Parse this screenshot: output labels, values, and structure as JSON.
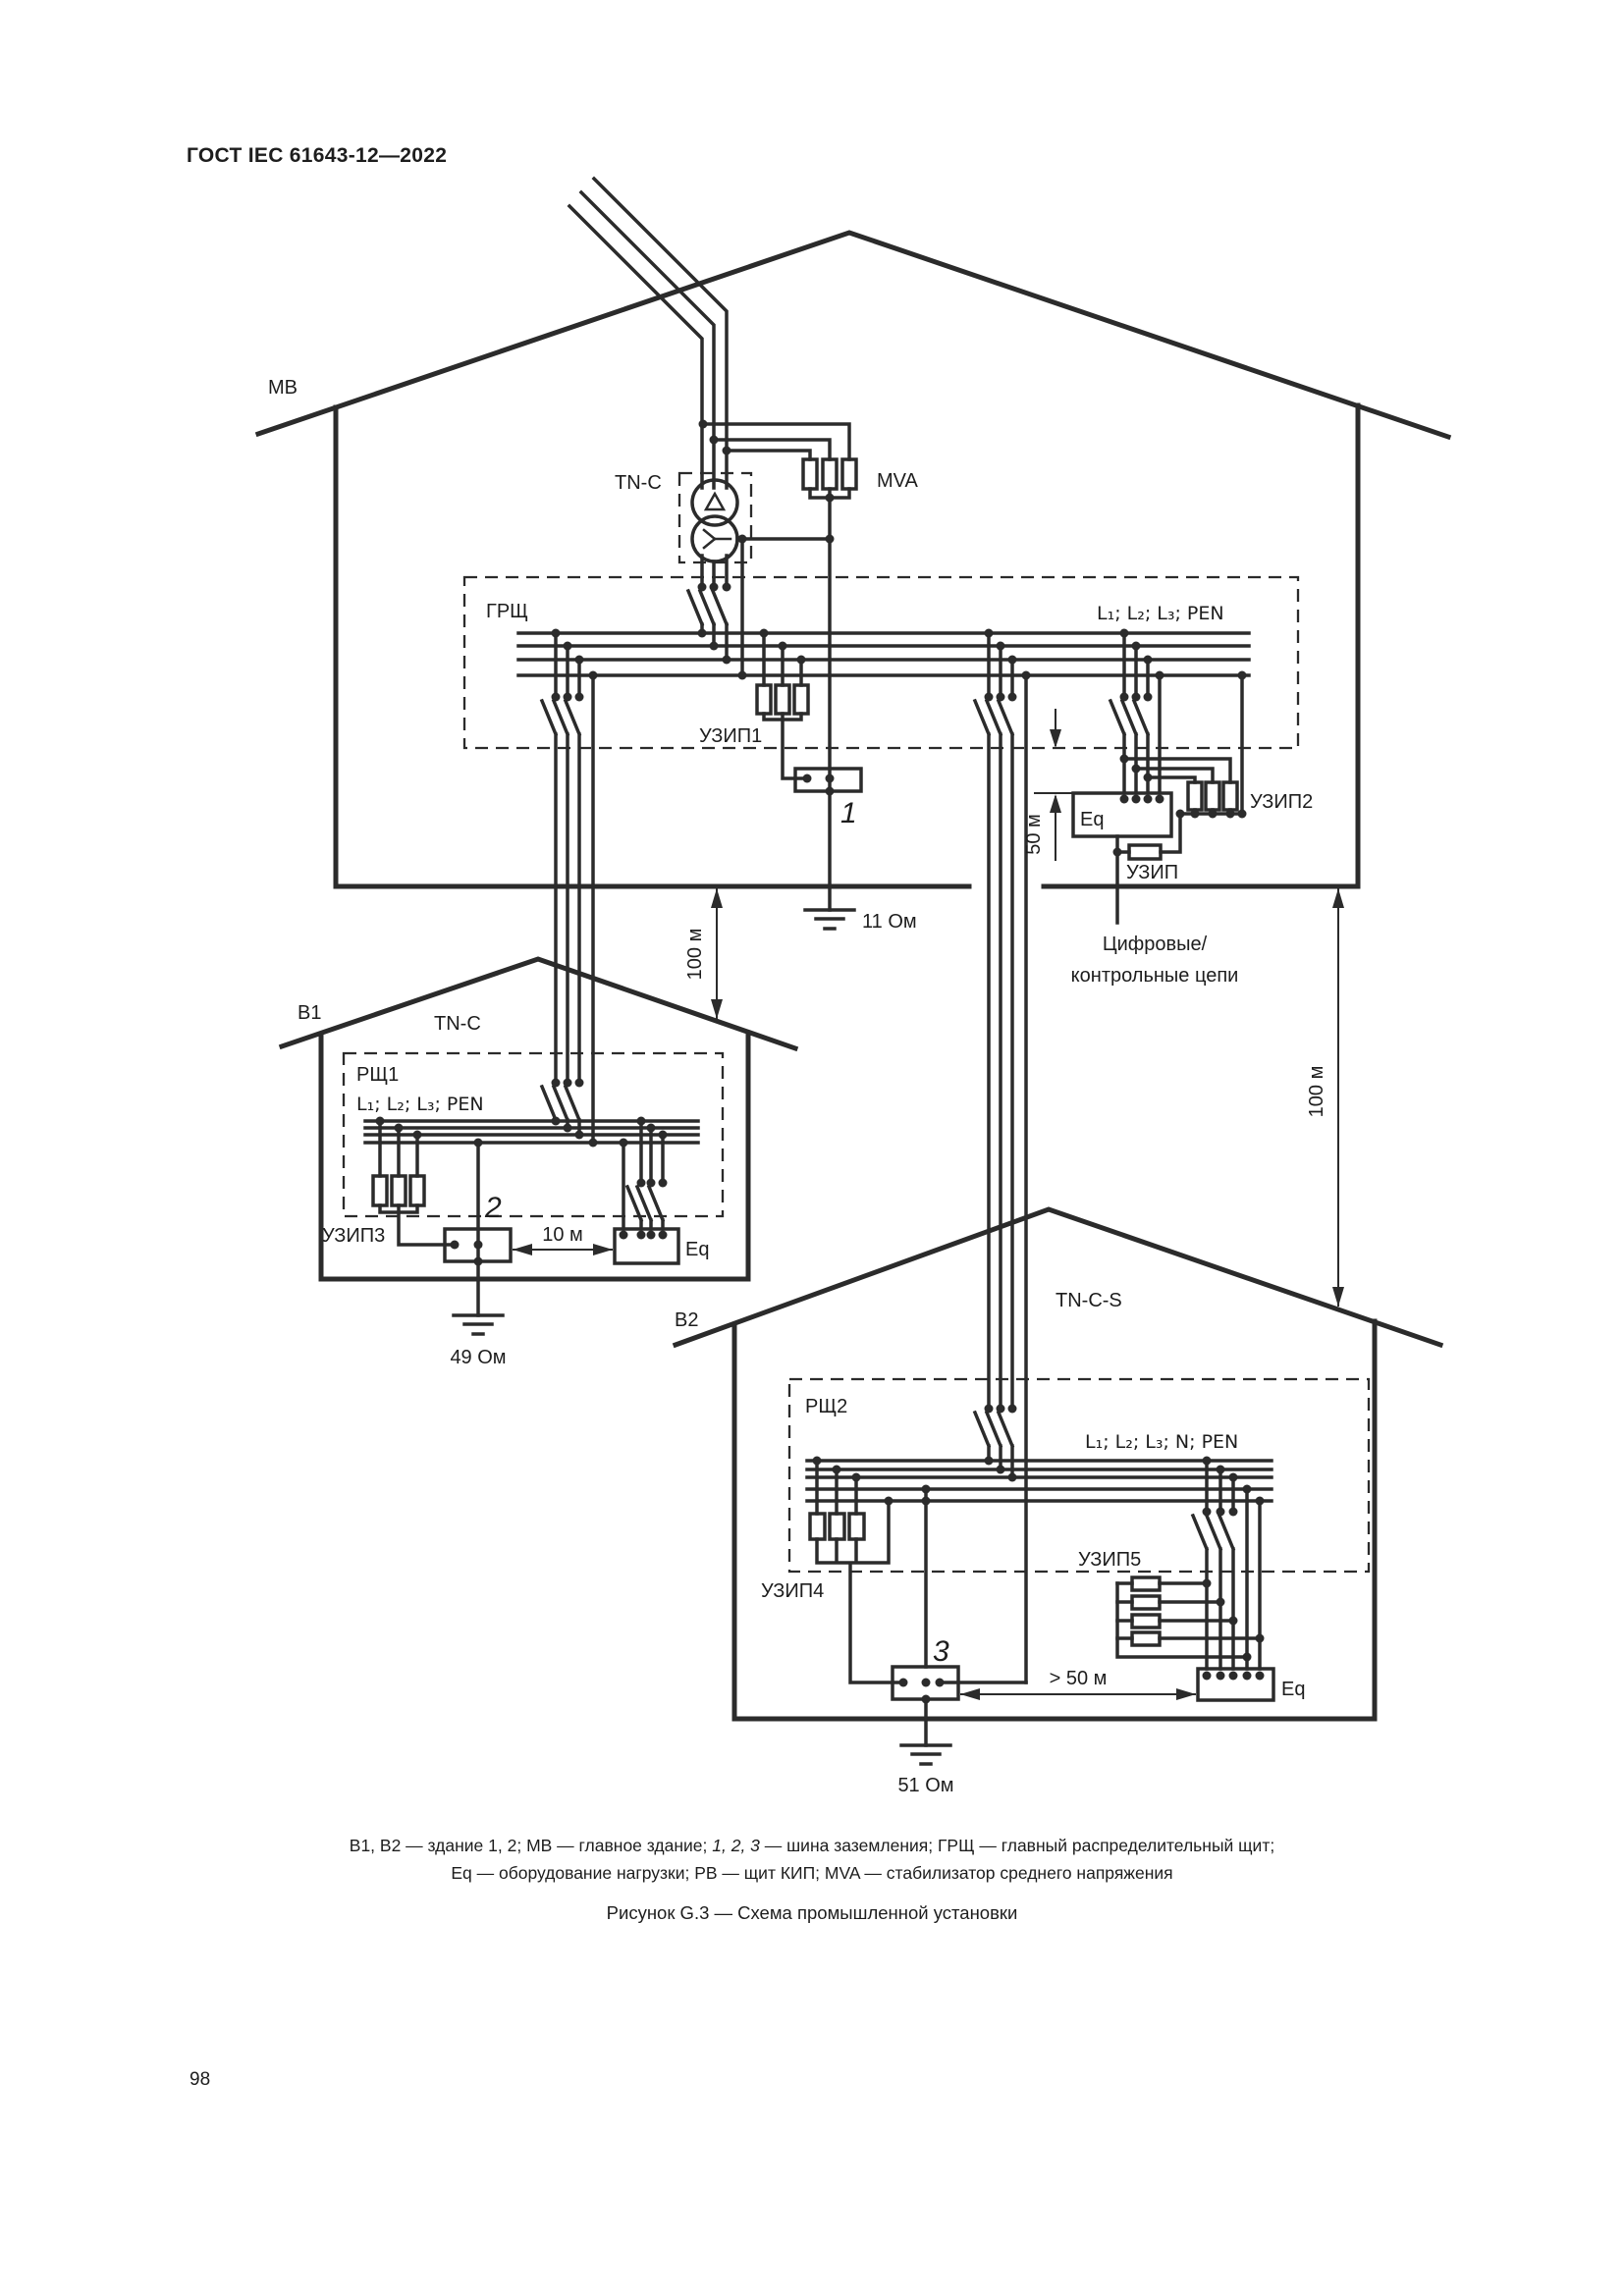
{
  "page": {
    "header_title": "ГОСТ IEC 61643-12—2022",
    "page_number": "98"
  },
  "diagram": {
    "dims": {
      "m100_left": "100 м",
      "m100_right": "100 м",
      "m50": "50 м",
      "m10": "10 м",
      "m50_plus": "> 50 м"
    },
    "main_building": {
      "label": "МВ",
      "system": "TN-C",
      "mva": "MVA",
      "board": "ГРЩ",
      "phases": "L₁; L₂; L₃; PEN",
      "spd1": "УЗИП1",
      "spd2": "УЗИП2",
      "spd": "УЗИП",
      "equipment": "Eq",
      "earth_bus": "1",
      "earth_resistance": "11 Ом",
      "digital_line1": "Цифровые/",
      "digital_line2": "контрольные цепи"
    },
    "building1": {
      "label": "B1",
      "system": "TN-C",
      "board": "РЩ1",
      "phases": "L₁; L₂; L₃; PEN",
      "spd3": "УЗИП3",
      "equipment": "Eq",
      "earth_bus": "2",
      "earth_resistance": "49 Ом"
    },
    "building2": {
      "label": "B2",
      "system": "TN-C-S",
      "board": "РЩ2",
      "phases": "L₁; L₂; L₃; N; PEN",
      "spd4": "УЗИП4",
      "spd5": "УЗИП5",
      "equipment": "Eq",
      "earth_bus": "3",
      "earth_resistance": "51 Ом"
    }
  },
  "caption": {
    "line1_pre": "B1, B2 — здание 1, 2; МВ — главное здание; ",
    "line1_italic": "1, 2, 3",
    "line1_post": " — шина заземления; ГРЩ — главный распределительный щит;",
    "line2": "Eq — оборудование нагрузки; РВ — щит КИП; MVA — стабилизатор среднего напряжения",
    "figure": "Рисунок G.3 — Схема промышленной установки"
  }
}
